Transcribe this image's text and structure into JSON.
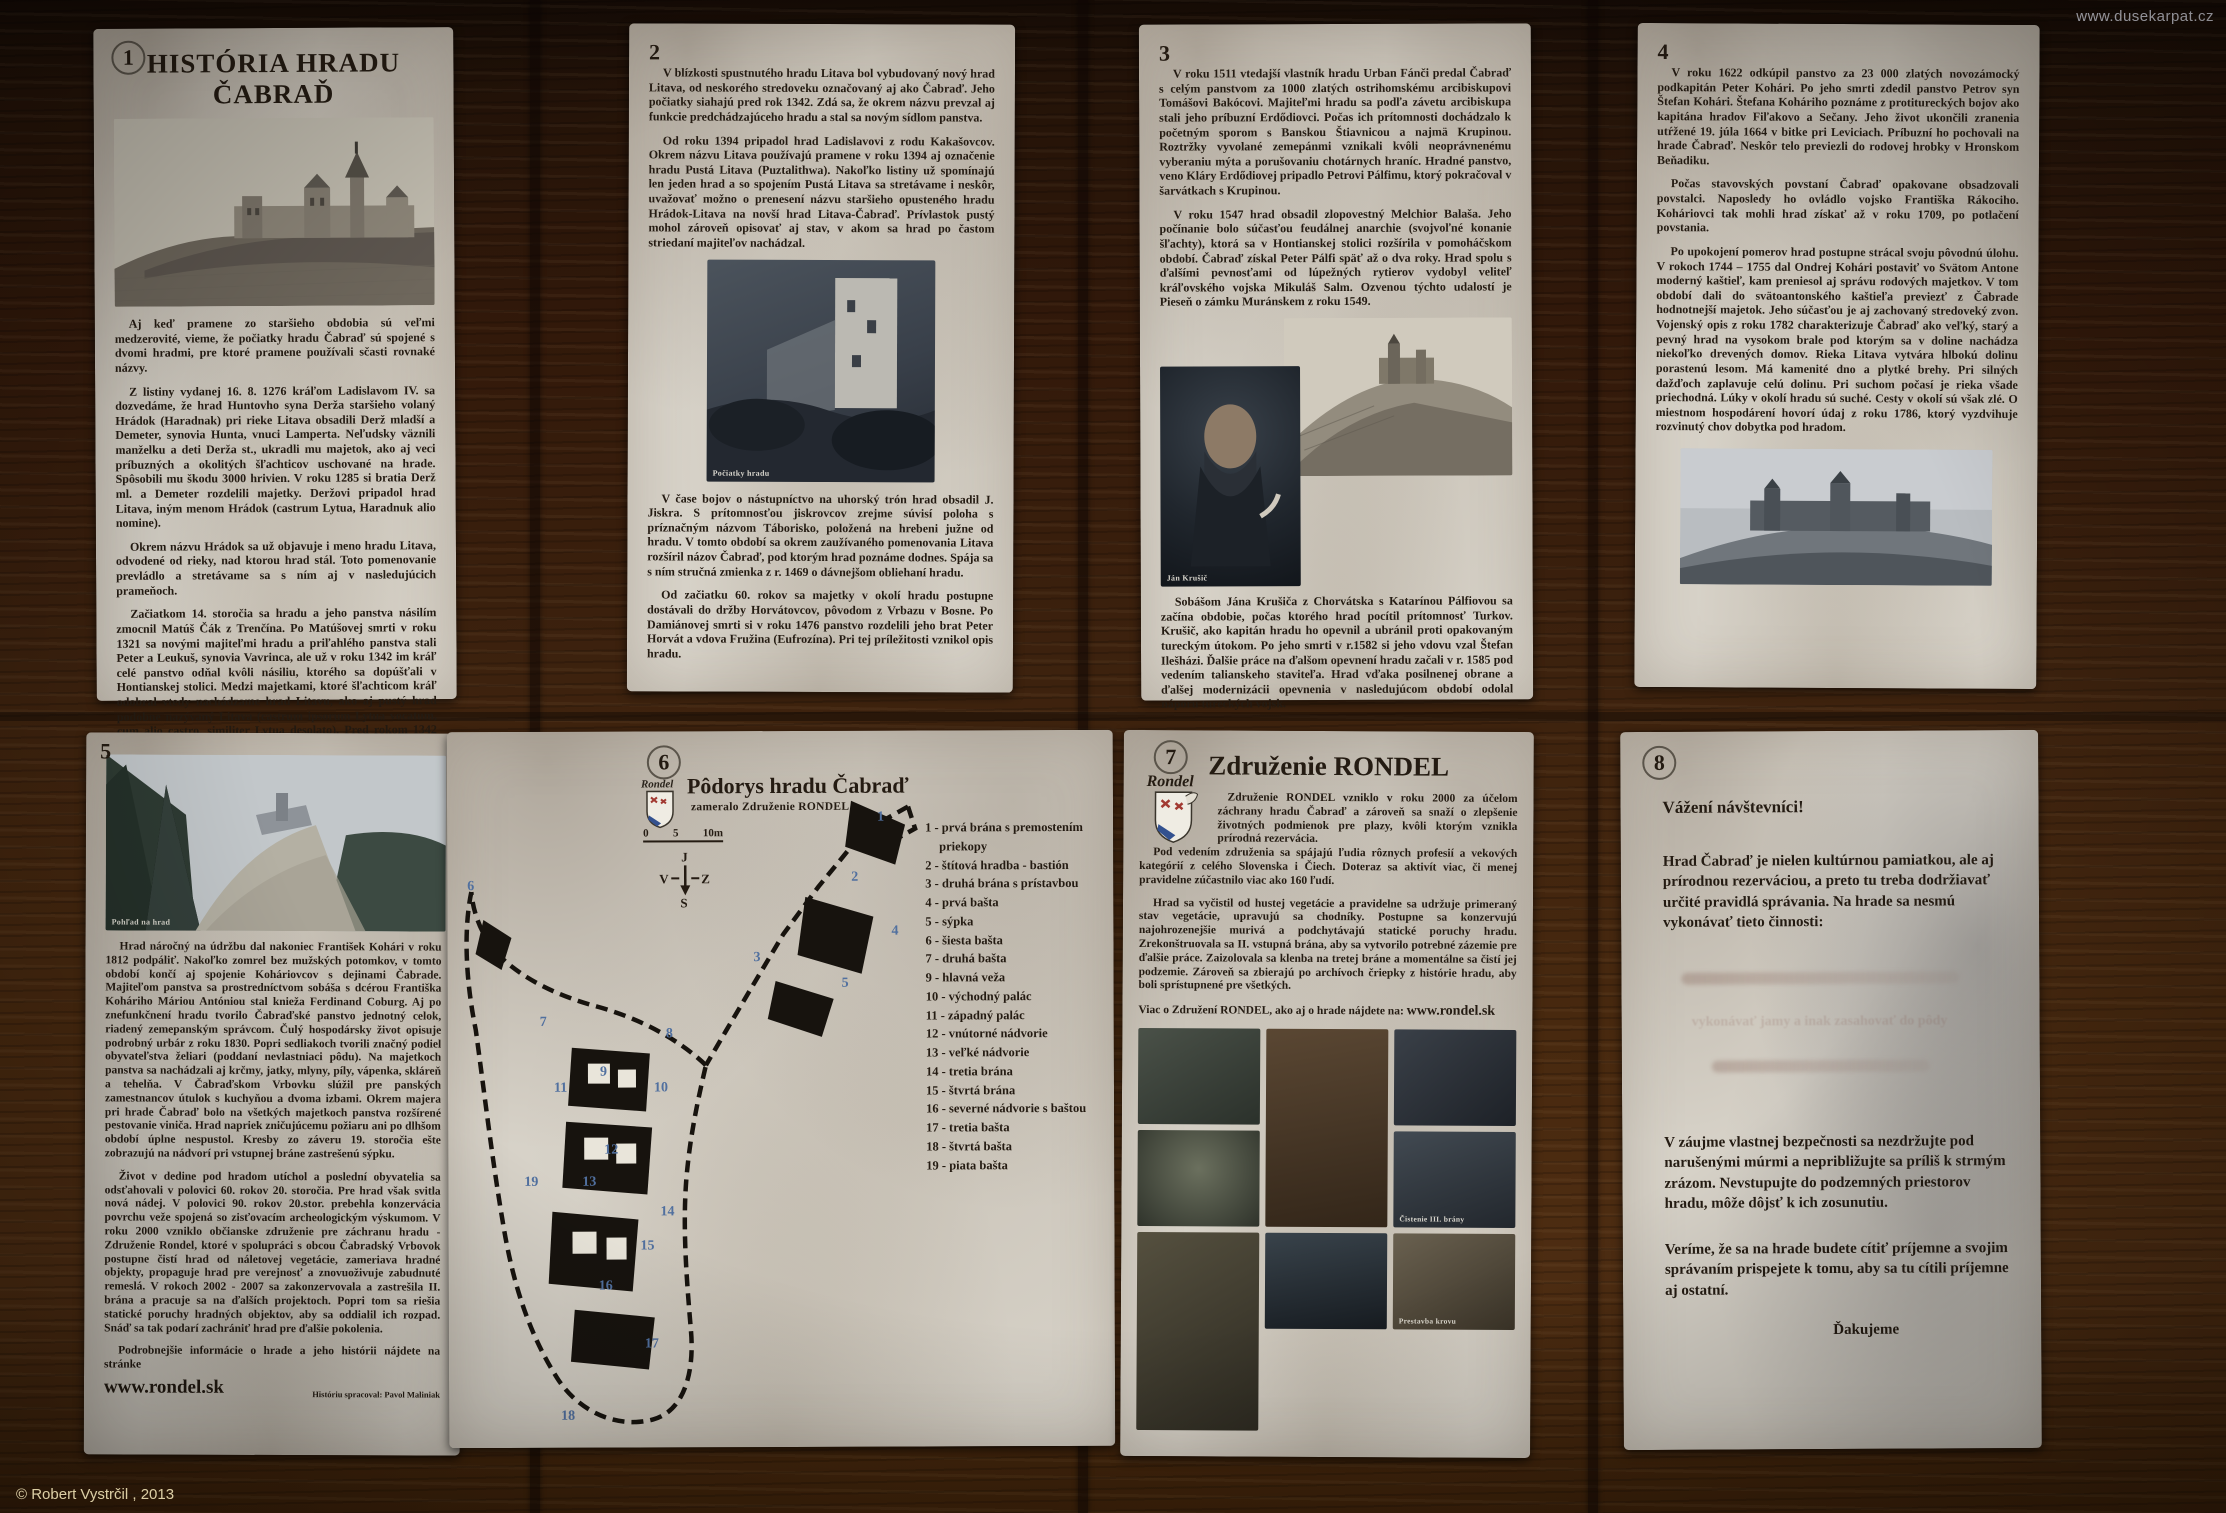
{
  "page": {
    "watermark": "www.dusekarpat.cz",
    "copyright": "© Robert Vystrčil , 2013",
    "colors": {
      "paper": "#d7d2c8",
      "wood_dark": "#241308",
      "wood_light": "#4e2d12",
      "plan_number_blue": "#51709f",
      "ink": "#241b12"
    }
  },
  "panel1": {
    "number": "1",
    "title": "HISTÓRIA HRADU ČABRAĎ",
    "image": "castle-engraving",
    "paragraphs": [
      "Aj keď pramene zo staršieho obdobia sú veľmi medzerovité, vieme, že počiatky hradu Čabraď sú spojené s dvomi hradmi, pre ktoré pramene používali sčasti rovnaké názvy.",
      "Z listiny vydanej 16. 8. 1276 kráľom Ladislavom IV. sa dozvedáme, že hrad Huntovho syna Derža staršieho volaný Hrádok (Haradnak) pri rieke Litava obsadili Derž mladší a Demeter, synovia Hunta, vnuci Lamperta. Neľudsky väznili manželku a deti Derža st., ukradli mu majetok, ako aj veci príbuzných a okolitých šľachticov uschované na hrade. Spôsobili mu škodu 3000 hrivien. V roku 1285 si bratia Derž ml. a Demeter rozdelili majetky. Deržovi pripadol hrad Litava, iným menom Hrádok (castrum Lytua, Haradnuk alio nomine).",
      "Okrem názvu Hrádok sa už objavuje i meno hradu Litava, odvodené od rieky, nad ktorou hrad stál. Toto pomenovanie prevládlo a stretávame sa s ním aj v nasledujúcich prameňoch.",
      "Začiatkom 14. storočia sa hradu a jeho panstva násilím zmocnil Matúš Čák z Trenčína. Po Matúšovej smrti v roku 1321 sa novými majiteľmi hradu a priľahlého panstva stali Peter a Leukuš, synovia Vavrinca, ale už v roku 1342 im kráľ celé panstvo odňal kvôli násiliu, ktorého sa dopúšťali v Hontianskej stolici. Medzi majetkami, ktoré šľachticom kráľ odobral vtedy nachádzame hrad Litavu, ako aj pustý hrad podobne nazývaný Litava (castrum ipsorum Lytua vocatum, cum alio castro, similiter Lytua desolato). Pred rokom 1342 končia dejiny staršieho hradu Litava, nazývaného aj Hrádok. Stavba bola pravdepodobne poškodená počas bojov a následne opustená."
    ]
  },
  "panel2": {
    "number": "2",
    "paragraphs_top": [
      "V blízkosti spustnutého hradu Litava bol vybudovaný nový hrad Litava, od neskorého stredoveku označovaný aj ako Čabraď. Jeho počiatky siahajú pred rok 1342. Zdá sa, že okrem názvu prevzal aj funkcie predchádzajúceho hradu a stal sa novým sídlom panstva.",
      "Od roku 1394 pripadol hrad Ladislavovi z rodu Kakašovcov. Okrem názvu Litava používajú pramene v roku 1394 aj označenie hradu Pustá Litava (Puztalithwa). Nakoľko listiny už spomínajú len jeden hrad a so spojením Pustá Litava sa stretávame i neskôr, uvažovať možno o prenesení názvu staršieho opusteného hradu Hrádok-Litava na novší hrad Litava-Čabraď. Prívlastok pustý mohol zároveň opisovať aj stav, v akom sa hrad po častom striedaní majiteľov nachádzal."
    ],
    "photo_caption": "Počiatky hradu",
    "paragraphs_bottom": [
      "V čase bojov o nástupníctvo na uhorský trón hrad obsadil J. Jiskra. S prítomnosťou jiskrovcov zrejme súvisí poloha s príznačným názvom Táborisko, položená na hrebeni južne od hradu. V tomto období sa okrem zaužívaného pomenovania Litava rozšíril názov Čabraď, pod ktorým hrad poznáme dodnes. Spája sa s ním stručná zmienka z r. 1469 o dávnejšom obliehaní hradu.",
      "Od začiatku 60. rokov sa majetky v okolí hradu postupne dostávali do držby Horvátovcov, pôvodom z Vrbazu v Bosne. Po Damiánovej smrti si v roku 1476 panstvo rozdelili jeho brat Peter Horvát a vdova Fružina (Eufrozína). Pri tej príležitosti vznikol opis hradu."
    ]
  },
  "panel3": {
    "number": "3",
    "paragraphs_top": [
      "V roku 1511 vtedajší vlastník hradu Urban Fánči predal Čabraď s celým panstvom za 1000 zlatých ostrihomskému arcibiskupovi Tomášovi Bakócovi. Majiteľmi hradu sa podľa závetu arcibiskupa stali jeho príbuzní Erdődiovci. Počas ich prítomnosti dochádzalo k početným sporom s Banskou Štiavnicou a najmä Krupinou. Roztržky vyvolané zemepánmi vznikali kvôli neoprávnenému vyberaniu mýta a porušovaniu chotárnych hraníc. Hradné panstvo, veno Kláry Erdődiovej pripadlo Petrovi Pálfimu, ktorý pokračoval v šarvátkach s Krupinou.",
      "V roku 1547 hrad obsadil zlopovestný Melchior Balaša. Jeho počínanie bolo súčasťou feudálnej anarchie (svojvoľné konanie šľachty), ktorá sa v Hontianskej stolici rozšírila v pomoháčskom období. Čabraď získal Peter Pálfi späť až o dva roky. Hrad spolu s ďalšími pevnosťami od lúpežných rytierov vydobyl veliteľ kráľovského vojska Mikuláš Salm. Ozvenou týchto udalostí je Pieseň o zámku Muránskem z roku 1549."
    ],
    "portrait_caption": "Ján Krušič",
    "paragraphs_bottom": [
      "Sobášom Jána Krušiča z Chorvátska s Katarínou Pálfiovou sa začína obdobie, počas ktorého hrad pocítil prítomnosť Turkov. Krušič, ako kapitán hradu ho opevnil a ubránil proti opakovaným tureckým útokom. Po jeho smrti v r.1582 si jeho vdovu vzal Štefan Ilešházi. Ďalšie práce na ďalšom opevnení hradu začali v r. 1585 pod vedením talianskeho staviteľa. Hrad vďaka posilnenej obrane a ďalšej modernizácii opevnenia v nasledujúcom období odolal náporu tureckých vojsk."
    ]
  },
  "panel4": {
    "number": "4",
    "paragraphs": [
      "V roku 1622 odkúpil panstvo za 23 000 zlatých novozámocký podkapitán Peter Kohári. Po jeho smrti zdedil panstvo Petrov syn Štefan Kohári. Štefana Koháriho poznáme z protitureckých bojov ako kapitána hradov Fiľakovo a Sečany. Jeho život ukončili zranenia utŕžené 19. júla 1664 v bitke pri Leviciach. Príbuzní ho pochovali na hrade Čabraď. Neskôr telo previezli do rodovej hrobky v Hronskom Beňadiku.",
      "Počas stavovských povstaní Čabraď opakovane obsadzovali povstalci. Naposledy ho ovládlo vojsko Františka Rákociho. Koháriovci tak mohli hrad získať až v roku 1709, po potlačení povstania.",
      "Po upokojení pomerov hrad postupne strácal svoju pôvodnú úlohu. V rokoch 1744 – 1755 dal Ondrej Kohári postaviť vo Svätom Antone moderný kaštieľ, kam preniesol aj správu rodových majetkov. V tom období dali do svätoantonského kaštieľa previezť z Čabrade hodnotnejší majetok. Jeho súčasťou je aj zachovaný stredoveký zvon. Vojenský opis z roku 1782 charakterizuje Čabraď ako veľký, starý a pevný hrad na vysokom brale pod ktorým sa v doline nachádza niekoľko drevených domov. Rieka Litava vytvára hlbokú dolinu porastenú lesom. Má kamenité dno a plytké brehy. Pri silných dažďoch zaplavuje celú dolinu. Pri suchom počasí je rieka všade priechodná. Lúky v okolí hradu sú suché. Cesty v okolí sú však zlé. O miestnom hospodárení hovorí údaj z roku 1786, ktorý vyzdvihuje rozvinutý chov dobytka pod hradom."
    ]
  },
  "panel5": {
    "number": "5",
    "photo_caption": "Pohľad na hrad",
    "paragraphs": [
      "Hrad náročný na údržbu dal nakoniec František Kohári v roku 1812 podpáliť. Nakoľko zomrel bez mužských potomkov, v tomto období končí aj spojenie Koháriovcov s dejinami Čabrade. Majiteľom panstva sa prostredníctvom sobáša s dcérou Františka Koháriho Máriou Antóniou stal knieža Ferdinand Coburg. Aj po znefunkčnení hradu tvorilo Čabraďské panstvo jednotný celok, riadený zemepanským správcom. Čulý hospodársky život opisuje podrobný urbár z roku 1830. Popri sedliakoch tvorili značný podiel obyvateľstva želiari (poddaní nevlastniaci pôdu). Na majetkoch panstva sa nachádzali aj krčmy, jatky, mlyny, píly, vápenka, skláreň a tehelňa. V Čabraďskom Vrbovku slúžil pre panských zamestnancov útulok s kuchyňou a dvoma izbami. Okrem majera pri hrade Čabraď bolo na všetkých majetkoch panstva rozšírené pestovanie viniča. Hrad napriek zničujúcemu požiaru ani po dlhšom období úplne nespustol. Kresby zo záveru 19. storočia ešte zobrazujú na nádvorí pri vstupnej bráne zastrešenú sýpku.",
      "Život v dedine pod hradom utíchol a poslední obyvatelia sa odsťahovali v polovici 60. rokov 20. storočia. Pre hrad však svitla nová nádej. V polovici 90. rokov 20.stor. prebehla konzervácia povrchu veže spojená so zisťovacím archeologickým výskumom. V roku 2000 vzniklo občianske združenie pre záchranu hradu - Združenie Rondel, ktoré v spolupráci s obcou Čabradský Vrbovok postupne čistí hrad od náletovej vegetácie, zameriava hradné objekty, propaguje hrad pre verejnosť a znovuoživuje zabudnuté remeslá. V rokoch 2002 - 2007 sa zakonzervovala a zastrešila II. brána a pracuje sa na ďalších projektoch. Popri tom sa riešia statické poruchy hradných objektov, aby sa oddialil ich rozpad. Snáď sa tak podarí zachrániť hrad pre ďalšie pokolenia."
    ],
    "footer_text": "Podrobnejšie informácie o hrade a jeho histórii nájdete na stránke",
    "link": "www.rondel.sk",
    "credit": "Históriu spracoval: Pavol Maliniak"
  },
  "panel6": {
    "number": "6",
    "title": "Pôdorys hradu Čabraď",
    "subtitle": "zameralo Združenie RONDEL",
    "scale_labels": {
      "zero": "0",
      "five": "5",
      "ten": "10m"
    },
    "compass": {
      "top": "J",
      "left": "V",
      "right": "Z",
      "bottom": "S"
    },
    "plan_numbers": [
      "1",
      "2",
      "3",
      "4",
      "5",
      "6",
      "7",
      "8",
      "9",
      "10",
      "11",
      "12",
      "13",
      "14",
      "15",
      "16",
      "17",
      "18",
      "19"
    ],
    "legend": [
      "1 - prvá brána s premostením priekopy",
      "2 - štítová hradba - bastión",
      "3 - druhá brána s prístavbou",
      "4 - prvá bašta",
      "5 - sýpka",
      "6 - šiesta bašta",
      "7 - druhá bašta",
      "8 - bastión horného hradu",
      "9 - hlavná veža",
      "10 - východný palác",
      "11 - západný palác",
      "12 - vnútorné nádvorie",
      "13 - veľké nádvorie",
      "14 - tretia brána",
      "15 - štvrtá brána",
      "16 - severné nádvorie s baštou",
      "17 - tretia bašta",
      "18 - štvrtá bašta",
      "19 - piata bašta"
    ]
  },
  "panel7": {
    "number": "7",
    "logo_text": "Rondel",
    "title": "Združenie RONDEL",
    "paragraphs": [
      "Združenie RONDEL vzniklo v roku 2000 za účelom záchrany hradu Čabraď a zároveň sa snaží o zlepšenie životných podmienok pre plazy, kvôli ktorým vznikla prírodná rezervácia.",
      "Pod vedením združenia sa spájajú ľudia rôznych profesií a vekových kategórií z celého Slovenska i Čiech. Doteraz sa aktivít viac, či menej pravidelne zúčastnilo viac ako 160 ľudí.",
      "Hrad sa vyčistil od hustej vegetácie a pravidelne sa udržuje primeraný stav vegetácie, upravujú sa chodníky. Postupne sa konzervujú najohrozenejšie murivá a podchytávajú statické poruchy hradu. Zrekonštruovala sa II. vstupná brána, aby sa vytvorilo potrebné zázemie pre ďalšie práce. Zaizolovala sa klenba na tretej bráne a momentálne sa čistí jej podzemie. Zároveň sa zbierajú po archívoch čriepky z histórie hradu, aby boli sprístupnené pre všetkých."
    ],
    "more_info_prefix": "Viac o Združení RONDEL, ako aj o hrade nájdete na: ",
    "link": "www.rondel.sk",
    "photo_captions": {
      "cleaning": "Čistenie III. brány",
      "roof": "Prestavba krovu"
    }
  },
  "panel8": {
    "number": "8",
    "heading": "Vážení návštevníci!",
    "intro": "Hrad Čabraď je nielen kultúrnou pamiatkou, ale aj prírodnou rezerváciou, a preto tu treba dodržiavať určité pravidlá správania. Na hrade sa nesmú vykonávať tieto činnosti:",
    "faded_line": "vykonávať jamy a inak zasahovať do pôdy",
    "safety": "V záujme vlastnej bezpečnosti sa nezdržujte pod narušenými múrmi a nepribližujte sa príliš k strmým zrázom. Nevstupujte do podzemných priestorov hradu, môže dôjsť k ich zosunutiu.",
    "closing": "Veríme, že sa na hrade budete cítiť príjemne a svojim správaním prispejete k tomu, aby sa tu cítili príjemne aj ostatní.",
    "thanks": "Ďakujeme"
  }
}
